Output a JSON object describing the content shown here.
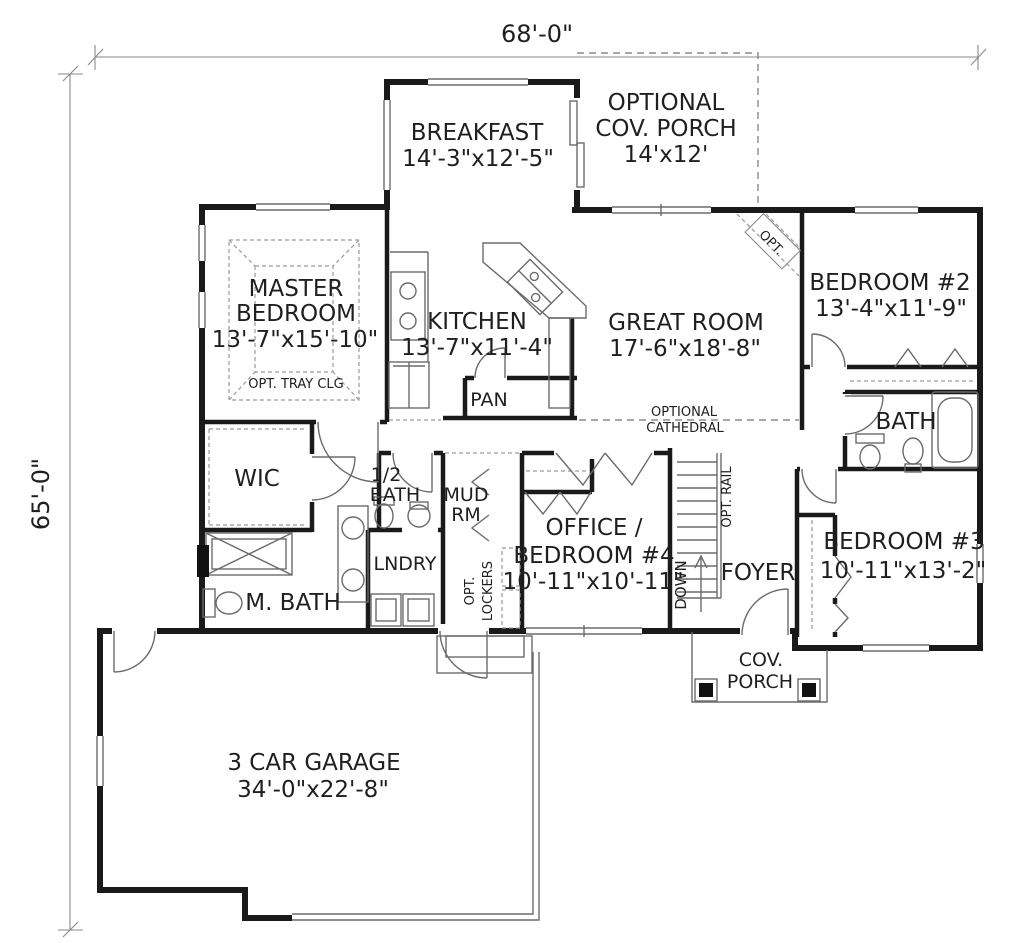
{
  "plan": {
    "dim_width": "68'-0\"",
    "dim_height": "65'-0\"",
    "colors": {
      "wall": "#1a1a1a",
      "thin_line": "#6b6b6b",
      "dashed_line": "#8c8c8c",
      "text": "#1f1f1f",
      "background": "#ffffff"
    },
    "rooms": {
      "breakfast": {
        "name": "BREAKFAST",
        "size": "14'-3\"x12'-5\""
      },
      "optional_porch": {
        "line1": "OPTIONAL",
        "line2": "COV. PORCH",
        "size": "14'x12'"
      },
      "master_bedroom": {
        "line1": "MASTER",
        "line2": "BEDROOM",
        "size": "13'-7\"x15'-10\"",
        "note": "OPT. TRAY CLG"
      },
      "kitchen": {
        "name": "KITCHEN",
        "size": "13'-7\"x11'-4\""
      },
      "pantry": {
        "name": "PAN"
      },
      "great_room": {
        "name": "GREAT ROOM",
        "size": "17'-6\"x18'-8\"",
        "note1": "OPTIONAL",
        "note2": "CATHEDRAL",
        "fireplace_note": "OPT."
      },
      "bedroom2": {
        "name": "BEDROOM #2",
        "size": "13'-4\"x11'-9\""
      },
      "bath2": {
        "name": "BATH"
      },
      "wic": {
        "name": "WIC"
      },
      "half_bath": {
        "line1": "1/2",
        "line2": "BATH"
      },
      "mud_room": {
        "line1": "MUD",
        "line2": "RM"
      },
      "laundry": {
        "name": "LNDRY"
      },
      "lockers": {
        "line1": "OPT.",
        "line2": "LOCKERS"
      },
      "office": {
        "line1": "OFFICE /",
        "line2": "BEDROOM #4",
        "size": "10'-11\"x10'-11\""
      },
      "foyer": {
        "name": "FOYER"
      },
      "stairs": {
        "down": "DOWN",
        "rail": "OPT. RAIL"
      },
      "bedroom3": {
        "name": "BEDROOM #3",
        "size": "10'-11\"x13'-2\""
      },
      "master_bath": {
        "name": "M. BATH"
      },
      "cov_porch": {
        "line1": "COV.",
        "line2": "PORCH"
      },
      "garage": {
        "name": "3 CAR GARAGE",
        "size": "34'-0\"x22'-8\""
      }
    }
  }
}
